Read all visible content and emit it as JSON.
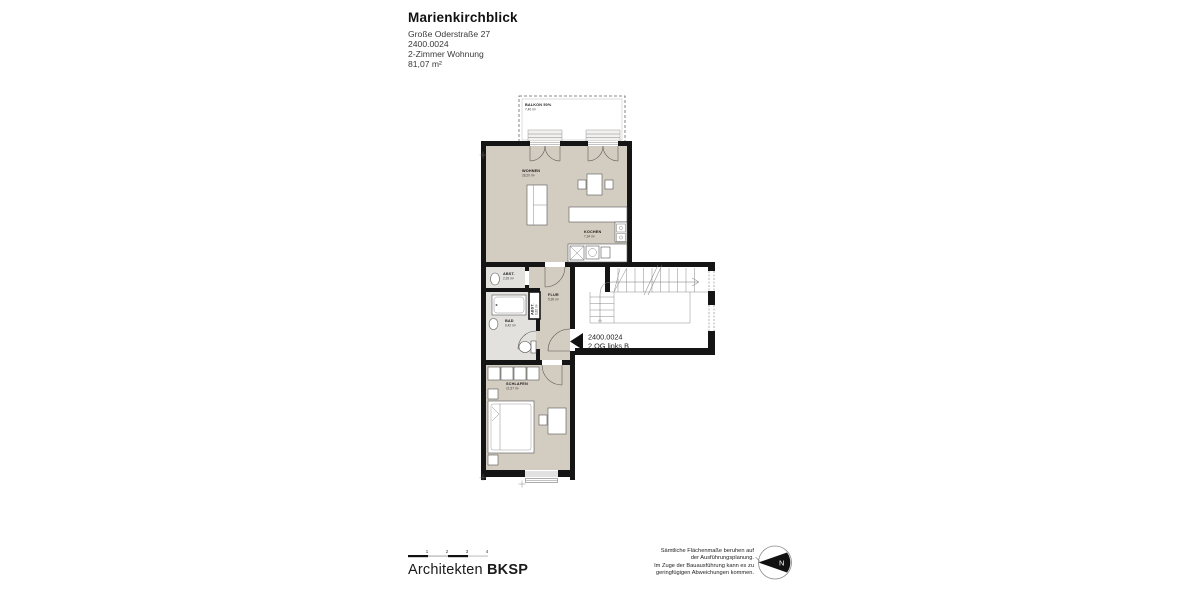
{
  "header": {
    "title": "Marienkirchblick",
    "address": "Große Oderstraße 27",
    "unit_id": "2400.0024",
    "apartment_type": "2-Zimmer Wohnung",
    "total_area": "81,07 m²"
  },
  "rooms": {
    "balkon": {
      "name": "BALKON 50%",
      "area": "7,40 m²"
    },
    "wohnen": {
      "name": "WOHNEN",
      "area": "28,20 m²"
    },
    "kochen": {
      "name": "KOCHEN",
      "area": "7,34 m²"
    },
    "abst": {
      "name": "ABST.",
      "area": "2,93 m²"
    },
    "abst2": {
      "name": "ABST.",
      "area": "0,82 m²"
    },
    "flur": {
      "name": "FLUR",
      "area": "5,99 m²"
    },
    "bad": {
      "name": "BAD",
      "area": "6,42 m²"
    },
    "schlafen": {
      "name": "SCHLAFEN",
      "area": "21,57 m²"
    }
  },
  "unit_label": {
    "line1": "2400.0024",
    "line2": "2.OG links B"
  },
  "footer": {
    "scale_ticks": [
      "1",
      "2",
      "3",
      "4"
    ],
    "firm_name": "Architekten",
    "firm_abbr": "BKSP",
    "disclaimer_lines": [
      "Sämtliche Flächenmaße beruhen auf",
      "der Ausführungsplanung.",
      "Im Zuge der Bauausführung kann es zu",
      "geringfügigen Abweichungen kommen."
    ],
    "north_label": "N"
  },
  "colors": {
    "wall": "#151515",
    "floor": "#d3ccc1",
    "wet_floor": "#e3e1dd"
  }
}
